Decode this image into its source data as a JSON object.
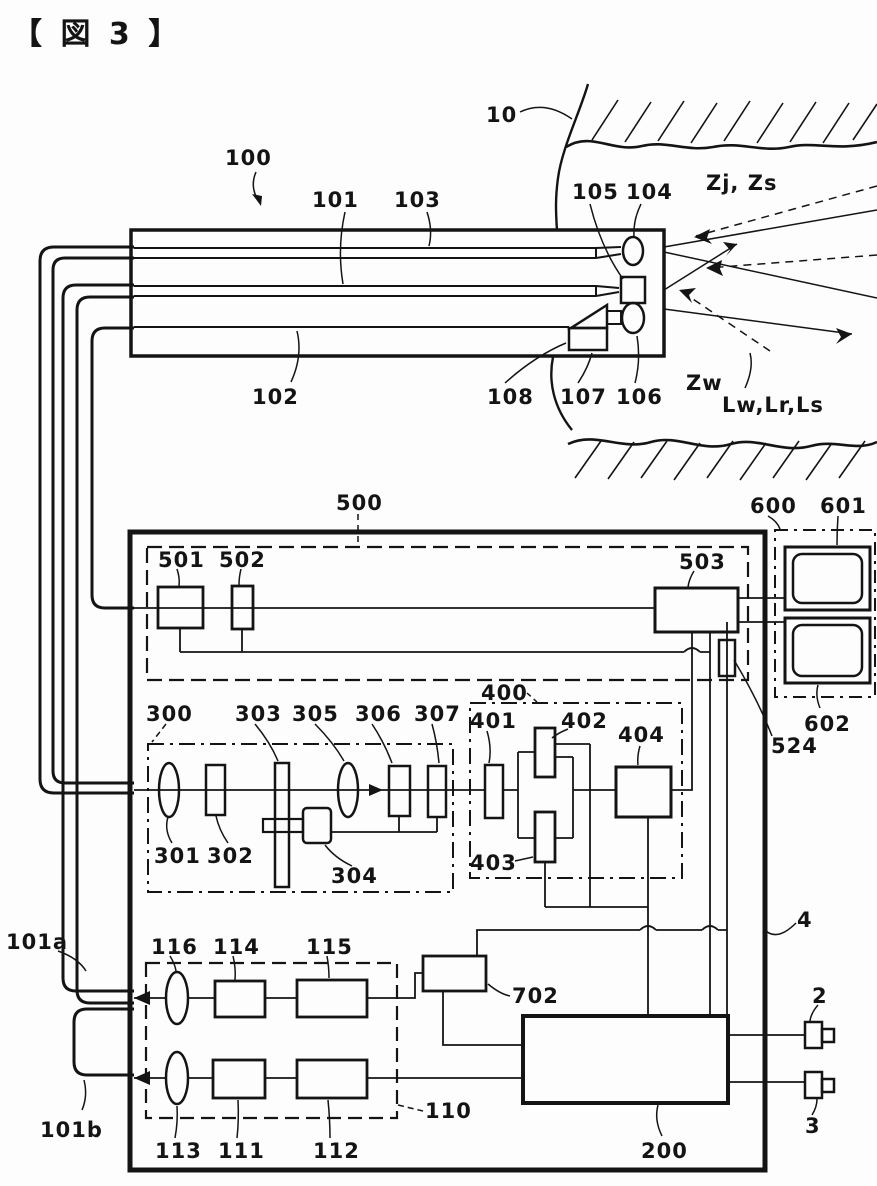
{
  "figure": {
    "title": "【 図 3 】"
  },
  "labels": {
    "n10": "10",
    "n100": "100",
    "n101": "101",
    "n102": "102",
    "n103": "103",
    "n104": "104",
    "n105": "105",
    "n106": "106",
    "n107": "107",
    "n108": "108",
    "n110": "110",
    "n111": "111",
    "n112": "112",
    "n113": "113",
    "n114": "114",
    "n115": "115",
    "n116": "116",
    "n200": "200",
    "n300": "300",
    "n301": "301",
    "n302": "302",
    "n303": "303",
    "n304": "304",
    "n305": "305",
    "n306": "306",
    "n307": "307",
    "n400": "400",
    "n401": "401",
    "n402": "402",
    "n403": "403",
    "n404": "404",
    "n500": "500",
    "n501": "501",
    "n502": "502",
    "n503": "503",
    "n524": "524",
    "n600": "600",
    "n601": "601",
    "n602": "602",
    "n702": "702",
    "n2": "2",
    "n3": "3",
    "n4": "4",
    "n101a": "101a",
    "n101b": "101b"
  },
  "annotations": {
    "zjzs": "Zj, Zs",
    "zw": "Zw",
    "lwlrls": "Lw,Lr,Ls"
  },
  "colors": {
    "ink": "#141414",
    "paper": "#fdfdfd"
  }
}
